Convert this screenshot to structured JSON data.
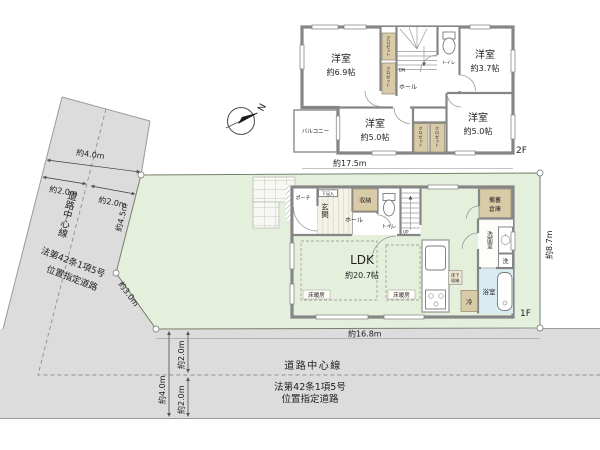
{
  "compass": {
    "north": "N"
  },
  "site": {
    "dim_width_2f": "約17.5m",
    "dim_width_1f": "約16.8m",
    "dim_depth_right": "約8.7m",
    "west_road": {
      "center_line": "道路中心線",
      "law_line1": "法第42条1項5号",
      "law_line2": "位置指定道路",
      "width_total": "約4.0m",
      "width_half_left": "約2.0m",
      "width_half_right": "約2.0m",
      "boundary_upper": "約4.5m",
      "boundary_corner": "約3.0m"
    },
    "south_road": {
      "center_line": "道路中心線",
      "law_line1": "法第42条1項5号",
      "law_line2": "位置指定道路",
      "width_total": "約4.0m",
      "width_half_upper": "約2.0m",
      "width_half_lower": "約2.0m"
    }
  },
  "floor2": {
    "label": "2F",
    "bedroom_a": {
      "name": "洋室",
      "area": "約6.9帖"
    },
    "bedroom_b": {
      "name": "洋室",
      "area": "約3.7帖"
    },
    "bedroom_c": {
      "name": "洋室",
      "area": "約5.0帖"
    },
    "bedroom_d": {
      "name": "洋室",
      "area": "約5.0帖"
    },
    "balcony": "バルコニー",
    "hall": "ホール",
    "toilet": "トイレ",
    "closet": "クロゼット",
    "stairs": "DN"
  },
  "floor1": {
    "label": "1F",
    "ldk": {
      "name": "LDK",
      "area": "約20.7帖"
    },
    "porch": "ポーチ",
    "entrance": "玄関",
    "shoe_box": "下足入",
    "hall": "ホール",
    "storage": "収納",
    "toilet": "トイレ",
    "stairs": "UP",
    "stock_storage_line1": "備蓄",
    "stock_storage_line2": "倉庫",
    "washroom": "洗面室",
    "laundry": "洗",
    "bathroom": "浴室",
    "fridge": "冷",
    "floor_heating": "床暖房",
    "underfloor_line1": "床下",
    "underfloor_line2": "収納"
  },
  "colors": {
    "road": "#dcdcdc",
    "lot_green": "#e5f0dc",
    "floor_cream": "#f8f3e1",
    "wall_gray": "#868686",
    "closet_beige": "#d9cba7",
    "bath_blue": "#d9ecf2"
  }
}
